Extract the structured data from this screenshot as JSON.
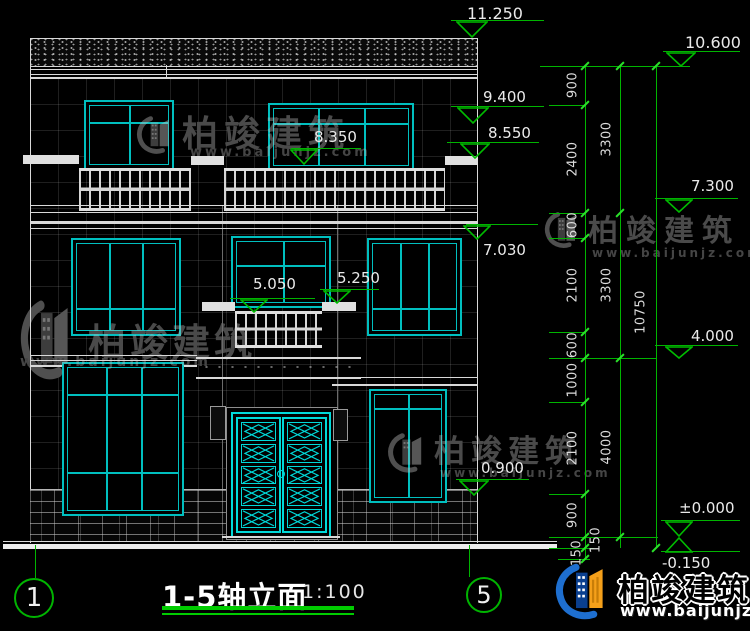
{
  "title_block": {
    "title": "1-5轴立面",
    "scale": "1:100"
  },
  "axes": {
    "left_bubble": "1",
    "right_bubble": "5"
  },
  "elevation_markers": {
    "left": [
      "11.250",
      "9.400",
      "8.550",
      "8.350",
      "7.030",
      "5.250",
      "5.050",
      "0.900"
    ],
    "right": [
      "10.600",
      "7.300",
      "4.000",
      "±0.000",
      "-0.150"
    ]
  },
  "dimensions": {
    "inner_chain": [
      "900",
      "2400",
      "600",
      "2100",
      "600",
      "1000",
      "2100",
      "900",
      "150",
      "150"
    ],
    "middle_chain": [
      "3300",
      "3300",
      "4000"
    ],
    "overall_chain": [
      "10750"
    ]
  },
  "watermark": {
    "brand": "柏竣建筑",
    "website": "www.baijunjz.com"
  },
  "brand_logo": {
    "brand": "柏竣建筑",
    "website": "www.baijunjz.com"
  },
  "colors": {
    "dimension_green": "#00b400",
    "window_cyan": "#00bfbf",
    "door_cyan": "#00d9d9"
  }
}
